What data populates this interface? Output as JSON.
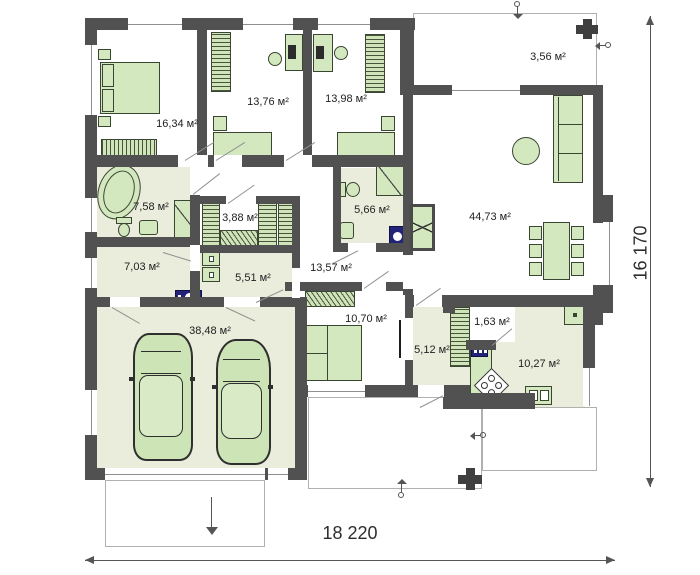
{
  "plan": {
    "type": "single-storey house floor plan",
    "overall_width_mm": "18 220",
    "overall_height_mm": "16 170",
    "rooms": {
      "bedroom1": {
        "area": "16,34 м²"
      },
      "bedroom2": {
        "area": "13,76 м²"
      },
      "bedroom3": {
        "area": "13,98 м²"
      },
      "porch": {
        "area": "3,56 м²"
      },
      "living": {
        "area": "44,73 м²"
      },
      "bathroom1": {
        "area": "7,58 м²"
      },
      "wardrobe": {
        "area": "3,88 м²"
      },
      "bathroom2": {
        "area": "5,66 м²"
      },
      "laundry": {
        "area": "7,03 м²"
      },
      "utility": {
        "area": "5,51 м²"
      },
      "hallway": {
        "area": "13,57 м²"
      },
      "bedroom4": {
        "area": "10,70 м²"
      },
      "garage": {
        "area": "38,48 м²"
      },
      "entryhall": {
        "area": "5,12 м²"
      },
      "pantry": {
        "area": "1,63 м²"
      },
      "kitchen": {
        "area": "10,27 м²"
      }
    },
    "colors": {
      "wall": "#515151",
      "floor_tint": "#eaecdc",
      "furniture_fill": "#d4e8c0",
      "furniture_outline": "#3a4632",
      "appliance_navy": "#232379",
      "dimension_text": "#2e2e2e",
      "terrace_outline": "#b0b0b0"
    }
  }
}
